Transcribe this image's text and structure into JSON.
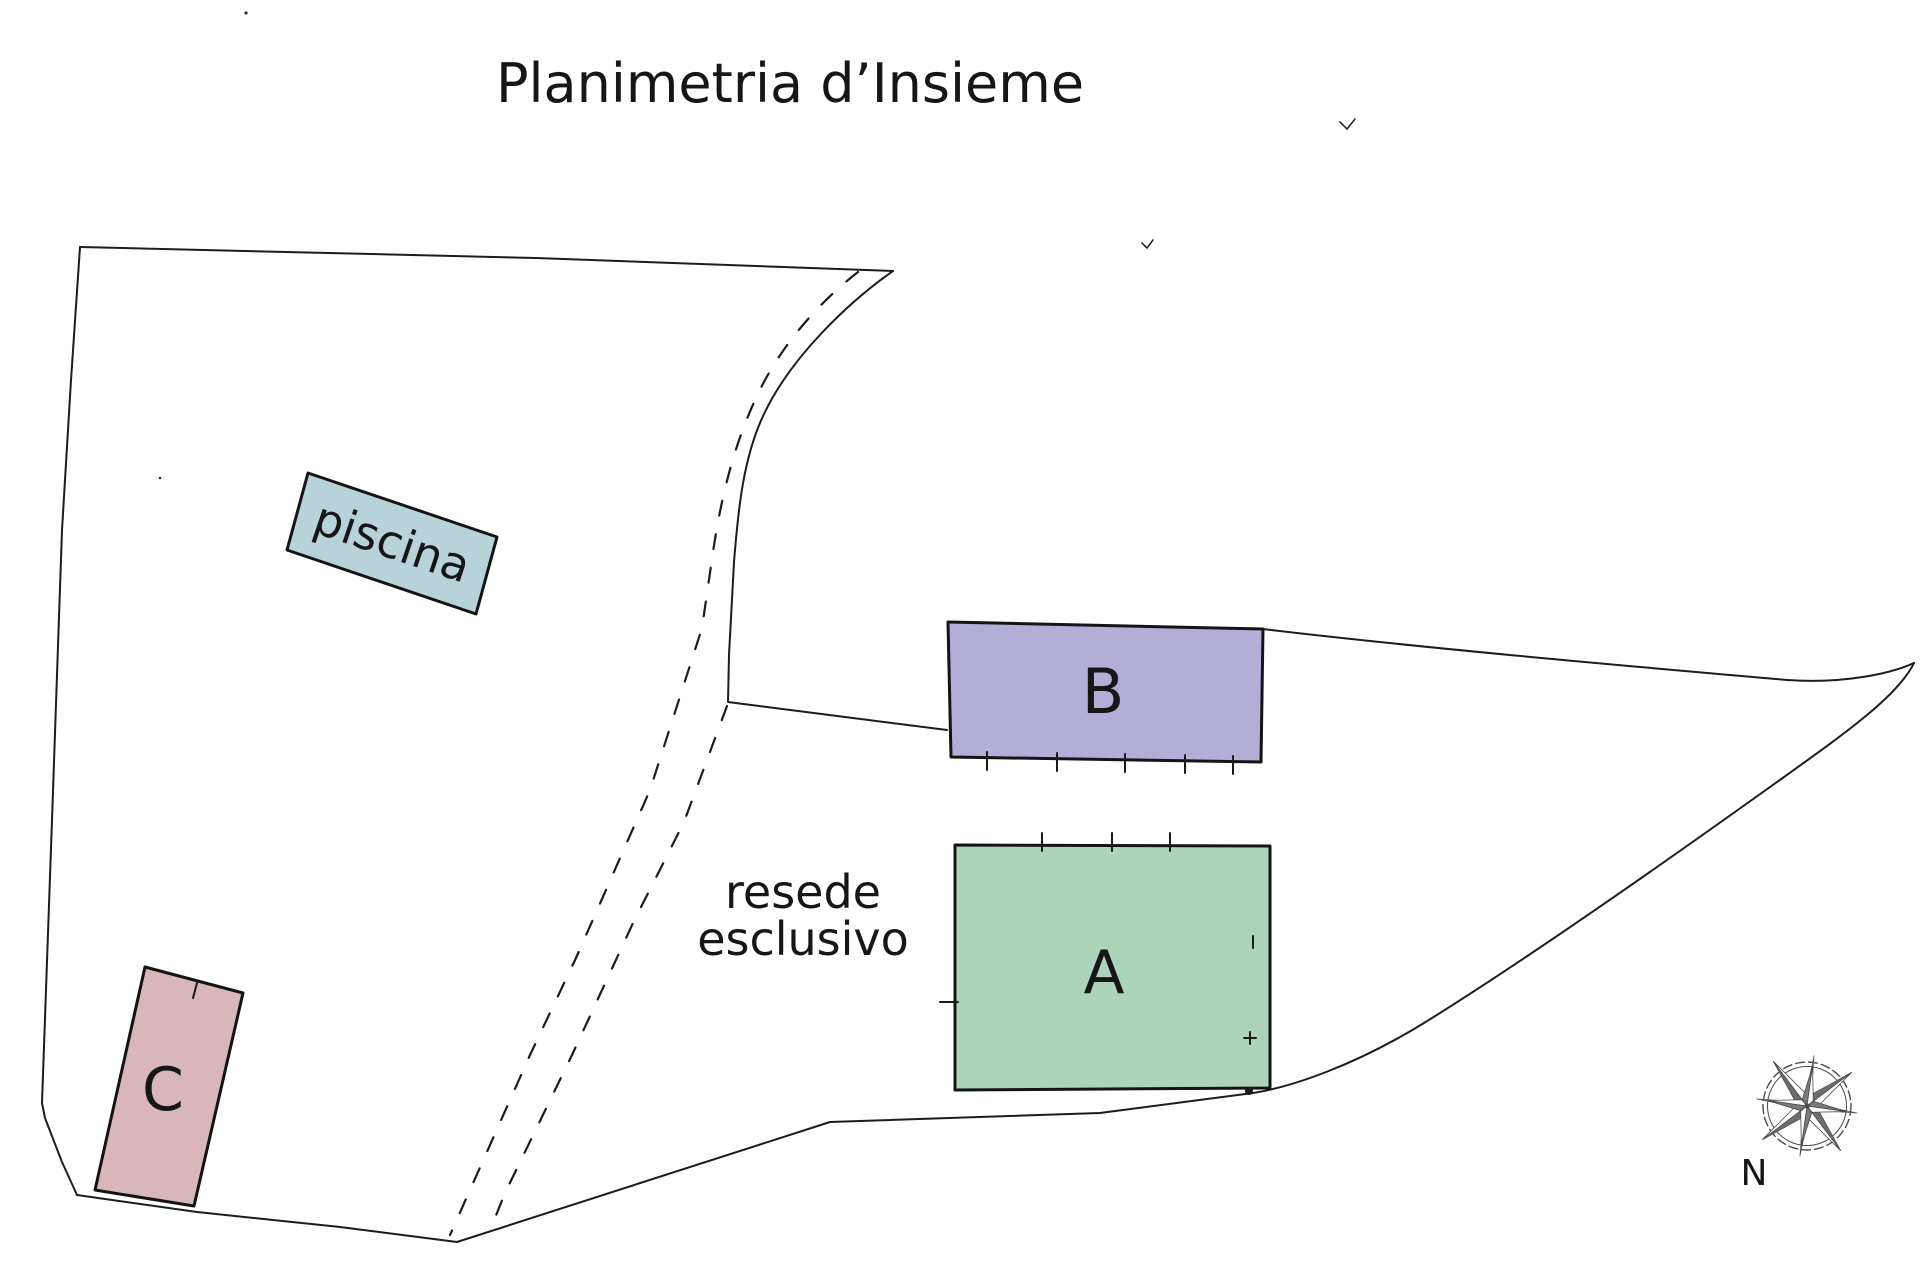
{
  "title": "Planimetria d’Insieme",
  "plan": {
    "parcels": [
      {
        "id": "A",
        "label": "A",
        "fill": "#acd4b9"
      },
      {
        "id": "B",
        "label": "B",
        "fill": "#b2aed8"
      },
      {
        "id": "C",
        "label": "C",
        "fill": "#d8b6b9"
      }
    ],
    "pool": {
      "label": "piscina",
      "fill": "#b7d2d8"
    },
    "area_label": {
      "line1": "resede",
      "line2": "esclusivo"
    },
    "compass": {
      "symbol": "compass-rose",
      "label": "N"
    }
  },
  "colors": {
    "background": "#ffffff",
    "line": "#1c1c1c",
    "parcel_a_fill": "#acd4b9",
    "parcel_b_fill": "#b2aed8",
    "parcel_c_fill": "#d8b6b9",
    "pool_fill": "#b7d2d8"
  }
}
